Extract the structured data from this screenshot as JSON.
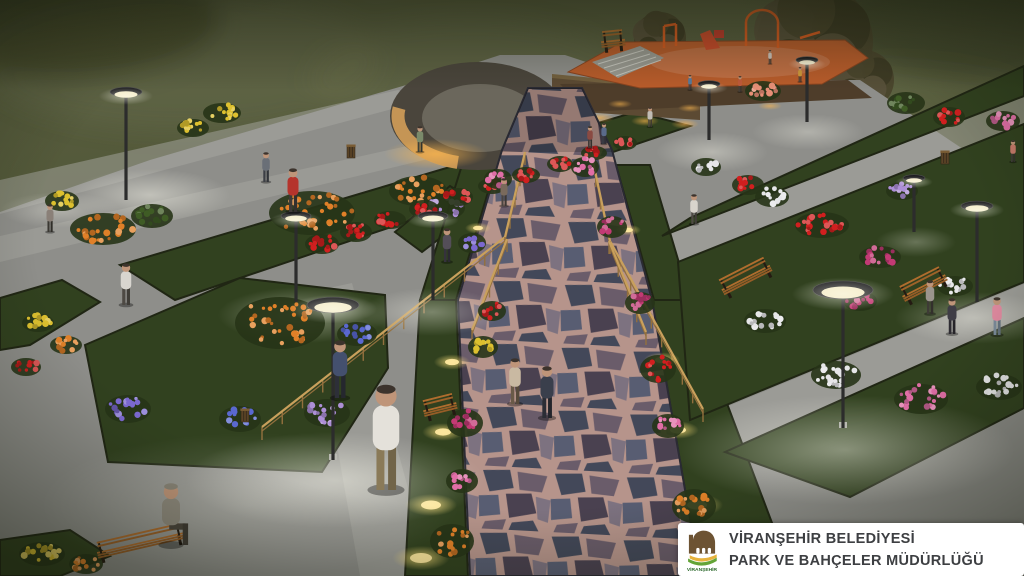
{
  "watermark": {
    "line1": "VİRANŞEHİR BELEDİYESİ",
    "line2": "PARK VE BAHÇELER MÜDÜRLÜĞÜ",
    "logo_text": "VİRANŞEHİR"
  },
  "palette": {
    "css": {
      "bg1": "#5a5f40",
      "bg2": "#4b5132",
      "bg3": "#3c4226",
      "fog": "#6e7252",
      "pave": "#8e8e8a",
      "paveLight": "#a8a8a2",
      "paveDim": "#6f6f6b",
      "grassDark": "#31411f",
      "grassLit": "#5f7a31",
      "gold": "#c8b832",
      "mortar": "#b6948b",
      "stone1": "#434859",
      "stone2": "#585d72",
      "stone3": "#6a5c6a",
      "stone4": "#7d7280",
      "stone5": "#4a4150",
      "wallAmber": "#cf9c58",
      "wallBrown": "#5c4a33",
      "wallTop": "#4a453c",
      "playFloor": "#b95c2b",
      "equip": "#d95b1f",
      "wood": "#b06d2e",
      "pole": "#2c2c2c",
      "treeA": "#4a452c",
      "treeB": "#57503a",
      "treeC": "#3d3a24",
      "skin": "#bf9579",
      "logoGreen": "#63a436",
      "logoBrown": "#6d5333",
      "logoYellow": "#e7b23c",
      "textDark": "#3d3f42",
      "cardBg": "#ffffff"
    },
    "flowers": {
      "red": "#d11f1f",
      "orange": "#e08028",
      "yellow": "#ddc02f",
      "pink": "#e06ea6",
      "magenta": "#c23a74",
      "purple": "#7b68d0",
      "blue": "#5a68d0",
      "white": "#e6e6e8",
      "lavender": "#ad8fd6",
      "salmon": "#e78f77",
      "green": "#3f5c25"
    }
  },
  "scene": {
    "description": "Night 3D render of a landscaped municipal park with lit walkways, flower beds, central flagstone promenade, ramp with railings, curved stone wall and playground",
    "lamps": [
      [
        126,
        200,
        108,
        16
      ],
      [
        296,
        302,
        86,
        15
      ],
      [
        333,
        460,
        155,
        26
      ],
      [
        433,
        300,
        84,
        15
      ],
      [
        843,
        428,
        138,
        30
      ],
      [
        977,
        302,
        96,
        16
      ],
      [
        914,
        232,
        54,
        11
      ],
      [
        709,
        140,
        56,
        11
      ],
      [
        807,
        122,
        62,
        11
      ]
    ],
    "ground_lights": [
      [
        452,
        362,
        7
      ],
      [
        443,
        432,
        8
      ],
      [
        431,
        505,
        10
      ],
      [
        421,
        558,
        11
      ],
      [
        662,
        360,
        7
      ],
      [
        678,
        430,
        8
      ],
      [
        697,
        505,
        10
      ],
      [
        714,
        556,
        11
      ],
      [
        478,
        228,
        5
      ],
      [
        628,
        230,
        5
      ]
    ],
    "light_pools": [
      [
        150,
        195,
        80,
        26,
        0.5
      ],
      [
        303,
        315,
        85,
        28,
        0.45
      ],
      [
        335,
        480,
        150,
        48,
        0.5
      ],
      [
        432,
        312,
        70,
        24,
        0.4
      ],
      [
        845,
        450,
        170,
        55,
        0.5
      ],
      [
        975,
        318,
        80,
        26,
        0.4
      ],
      [
        712,
        152,
        56,
        20,
        0.4
      ],
      [
        808,
        132,
        56,
        18,
        0.35
      ],
      [
        916,
        242,
        40,
        15,
        0.3
      ],
      [
        250,
        505,
        210,
        72,
        0.25
      ],
      [
        60,
        210,
        60,
        18,
        0.35
      ]
    ],
    "railings": [
      [
        505,
        237,
        262,
        427,
        12
      ],
      [
        610,
        241,
        703,
        409,
        9
      ],
      [
        505,
        237,
        525,
        152,
        4
      ],
      [
        610,
        241,
        591,
        152,
        4
      ],
      [
        507,
        239,
        472,
        330,
        4
      ],
      [
        609,
        241,
        646,
        332,
        4
      ]
    ],
    "trees": [
      [
        815,
        42,
        58
      ],
      [
        864,
        80,
        30
      ],
      [
        660,
        38,
        26
      ]
    ],
    "benches": [
      [
        142,
        552,
        -13,
        88
      ],
      [
        750,
        286,
        -27,
        54
      ],
      [
        928,
        294,
        -27,
        48
      ],
      [
        442,
        416,
        -14,
        34
      ],
      [
        614,
        50,
        -6,
        24
      ]
    ],
    "bins": [
      [
        245,
        422
      ],
      [
        351,
        158
      ],
      [
        945,
        164
      ]
    ],
    "people": [
      [
        126,
        305,
        42,
        "#d8d5cf",
        "#4e4a44",
        "walk"
      ],
      [
        266,
        182,
        30,
        "#6a6f77",
        "#3c3f45",
        "walk"
      ],
      [
        293,
        212,
        44,
        "#b5342c",
        "#3e3a38",
        "walk"
      ],
      [
        340,
        398,
        58,
        "#44506e",
        "#2d2f38",
        "walk"
      ],
      [
        386,
        490,
        106,
        "#e4e1da",
        "#8a7a58",
        "walk"
      ],
      [
        447,
        262,
        34,
        "#544e58",
        "#35323c",
        "walk"
      ],
      [
        504,
        206,
        28,
        "#7a6a5c",
        "#4a4440",
        "walk"
      ],
      [
        547,
        418,
        52,
        "#3a3f4c",
        "#2b2d35",
        "walk"
      ],
      [
        515,
        404,
        46,
        "#c9b9a2",
        "#6a5a48",
        "walk"
      ],
      [
        590,
        148,
        22,
        "#8a4a42",
        "#3f3a36",
        "walk"
      ],
      [
        604,
        144,
        21,
        "#5a6a8a",
        "#3a3c44",
        "walk"
      ],
      [
        650,
        127,
        20,
        "#c0bcb4",
        "#4a463e",
        "walk"
      ],
      [
        694,
        224,
        30,
        "#d8d4cc",
        "#4e4a44",
        "walk"
      ],
      [
        740,
        92,
        16,
        "#c05a3a",
        "#433f3a",
        "walk"
      ],
      [
        770,
        64,
        14,
        "#d0c8c0",
        "#45413c",
        "walk"
      ],
      [
        800,
        82,
        15,
        "#d09a3a",
        "#44403a",
        "walk"
      ],
      [
        690,
        90,
        15,
        "#5a7a9a",
        "#3c3e44",
        "walk"
      ],
      [
        930,
        314,
        34,
        "#9a948c",
        "#3e3b36",
        "walk"
      ],
      [
        952,
        334,
        36,
        "#3f3d46",
        "#2e2c32",
        "walk"
      ],
      [
        997,
        335,
        38,
        "#e08aa0",
        "#7a8a9a",
        "walk"
      ],
      [
        1013,
        162,
        22,
        "#c87a6a",
        "#3f3c38",
        "walk"
      ],
      [
        420,
        152,
        26,
        "#7a8a6a",
        "#3c4038",
        "walk"
      ],
      [
        50,
        232,
        28,
        "#8a8078",
        "#3a3832",
        "walk"
      ],
      [
        171,
        545,
        72,
        "#8f8a7e",
        "#4a443c",
        "sit"
      ]
    ],
    "flowers": [
      [
        "yellow",
        222,
        112,
        16,
        8
      ],
      [
        "yellow",
        193,
        127,
        13,
        7
      ],
      [
        "green",
        152,
        215,
        18,
        10
      ],
      [
        "orange",
        312,
        212,
        40,
        20
      ],
      [
        "orange",
        418,
        190,
        26,
        13
      ],
      [
        "lavender",
        444,
        207,
        18,
        10
      ],
      [
        "orange",
        103,
        228,
        30,
        14
      ],
      [
        "yellow",
        62,
        200,
        14,
        8
      ],
      [
        "red",
        322,
        243,
        14,
        8
      ],
      [
        "red",
        356,
        231,
        13,
        8
      ],
      [
        "red",
        390,
        219,
        13,
        7
      ],
      [
        "red",
        424,
        208,
        12,
        7
      ],
      [
        "red",
        458,
        196,
        12,
        7
      ],
      [
        "red",
        492,
        185,
        11,
        6
      ],
      [
        "red",
        526,
        174,
        11,
        6
      ],
      [
        "red",
        560,
        163,
        10,
        6
      ],
      [
        "red",
        594,
        152,
        10,
        5
      ],
      [
        "red",
        625,
        142,
        9,
        5
      ],
      [
        "orange",
        280,
        322,
        42,
        24
      ],
      [
        "blue",
        357,
        333,
        17,
        10
      ],
      [
        "lavender",
        327,
        412,
        20,
        12
      ],
      [
        "blue",
        240,
        418,
        18,
        11
      ],
      [
        "purple",
        128,
        408,
        20,
        12
      ],
      [
        "yellow",
        38,
        322,
        13,
        7
      ],
      [
        "red",
        26,
        366,
        12,
        7
      ],
      [
        "orange",
        66,
        344,
        13,
        7
      ],
      [
        "yellow",
        42,
        553,
        20,
        10
      ],
      [
        "orange",
        86,
        563,
        14,
        8
      ],
      [
        "magenta",
        465,
        422,
        15,
        12
      ],
      [
        "orange",
        452,
        540,
        19,
        15
      ],
      [
        "red",
        492,
        310,
        11,
        8
      ],
      [
        "yellow",
        483,
        346,
        12,
        9
      ],
      [
        "pink",
        462,
        480,
        13,
        10
      ],
      [
        "red",
        658,
        368,
        15,
        12
      ],
      [
        "orange",
        694,
        505,
        19,
        15
      ],
      [
        "yellow",
        708,
        550,
        17,
        13
      ],
      [
        "pink",
        668,
        425,
        13,
        10
      ],
      [
        "magenta",
        640,
        302,
        12,
        9
      ],
      [
        "pink",
        585,
        166,
        11,
        8
      ],
      [
        "magenta",
        612,
        226,
        12,
        9
      ],
      [
        "pink",
        498,
        178,
        11,
        8
      ],
      [
        "purple",
        472,
        242,
        11,
        8
      ],
      [
        "salmon",
        763,
        90,
        15,
        8
      ],
      [
        "pink",
        1003,
        120,
        14,
        8
      ],
      [
        "red",
        748,
        184,
        13,
        8
      ],
      [
        "white",
        706,
        166,
        12,
        7
      ],
      [
        "red",
        822,
        224,
        24,
        11
      ],
      [
        "magenta",
        880,
        256,
        18,
        9
      ],
      [
        "white",
        772,
        196,
        14,
        8
      ],
      [
        "lavender",
        902,
        190,
        13,
        7
      ],
      [
        "white",
        955,
        285,
        15,
        8
      ],
      [
        "white",
        765,
        320,
        18,
        10
      ],
      [
        "white",
        836,
        374,
        22,
        12
      ],
      [
        "pink",
        921,
        398,
        24,
        13
      ],
      [
        "white",
        999,
        386,
        20,
        11
      ],
      [
        "magenta",
        860,
        300,
        14,
        8
      ],
      [
        "red",
        956,
        560,
        16,
        9
      ],
      [
        "pink",
        988,
        556,
        13,
        8
      ],
      [
        "green",
        906,
        102,
        16,
        9
      ],
      [
        "red",
        949,
        116,
        13,
        8
      ]
    ]
  }
}
